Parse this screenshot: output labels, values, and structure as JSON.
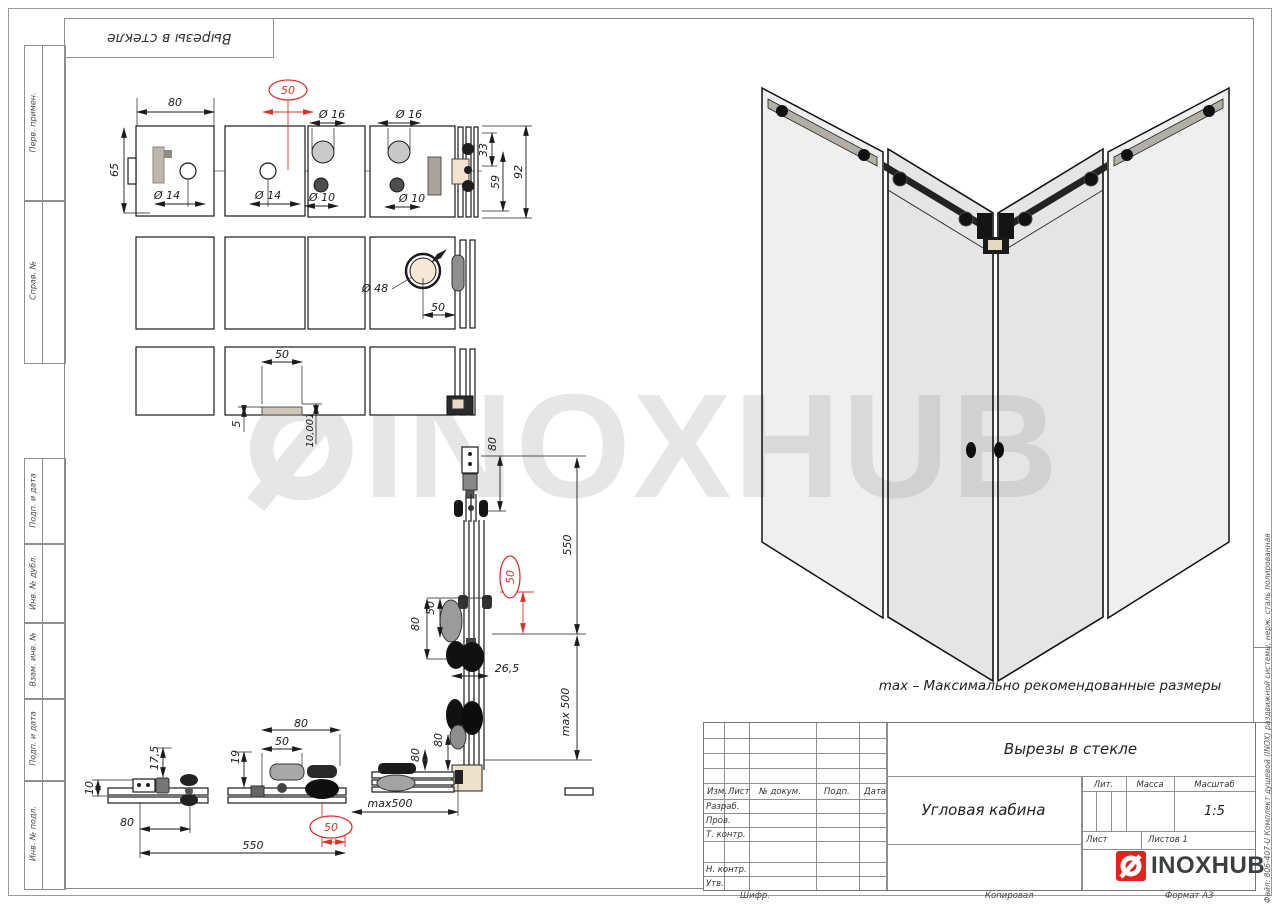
{
  "page": {
    "stamp_repeat_title": "Вырезы в стекле",
    "margin_labels_top": [
      "Перв. примен.",
      "Справ. №"
    ],
    "margin_labels_bottom": [
      "Подп. и дата",
      "Инв. № дубл.",
      "Взам. инв. №",
      "Подп. и дата",
      "Инв. № подл."
    ],
    "file_note": "Файл: 806-407-U Комплект душевой (INOX) раздвижной системы, нерж. сталь полированная",
    "footer": {
      "shifr": "Шифр.",
      "kopiroval": "Копировал",
      "format": "Формат А3"
    }
  },
  "watermark": {
    "text": "INOXHUB"
  },
  "note": "max – Максимально рекомендованные размеры",
  "title_block": {
    "title": "Вырезы в стекле",
    "doc_name": "Угловая кабина",
    "columns": [
      "Изм.",
      "Лист",
      "№ докум.",
      "Подп.",
      "Дата"
    ],
    "roles": [
      "Разраб.",
      "Пров.",
      "Т. контр.",
      "Н. контр.",
      "Утв."
    ],
    "lit": "Лит.",
    "massa": "Масса",
    "masshtab": "Масштаб",
    "masshtab_value": "1:5",
    "list": "Лист",
    "listov": "Листов 1",
    "brand": "INOXHUB"
  },
  "colors": {
    "accent_red": "#d8342c",
    "brand_red": "#e2231a",
    "line": "#1a1a1a",
    "frame_gray": "#8a8a8a",
    "watermark_gray": "#e6e6e6"
  },
  "dims": [
    "80",
    "65",
    "Ø 14",
    "50",
    "Ø 14",
    "Ø 16",
    "Ø 10",
    "Ø 16",
    "Ø 10",
    "33",
    "59",
    "92",
    "Ø 48",
    "50",
    "50",
    "5",
    "10,001",
    "80",
    "550",
    "50",
    "50",
    "80",
    "26,5",
    "max 500",
    "10",
    "17,5",
    "80",
    "550",
    "19",
    "50",
    "80",
    "50",
    "max500",
    "80",
    "80"
  ]
}
